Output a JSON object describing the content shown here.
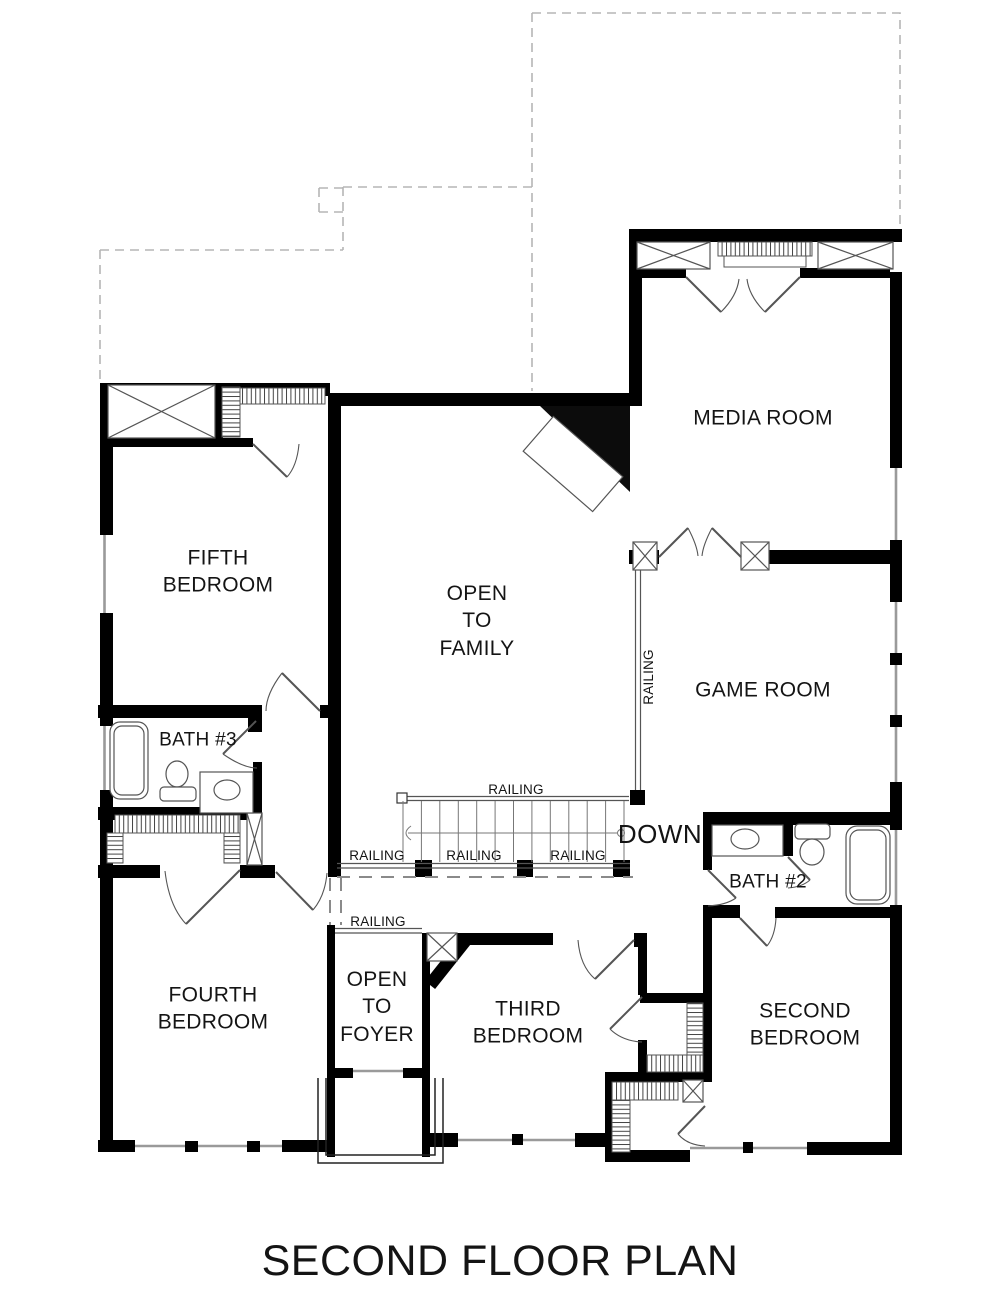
{
  "title": "SECOND FLOOR PLAN",
  "rooms": {
    "media_room": "MEDIA ROOM",
    "game_room": "GAME ROOM",
    "open_to_family": "OPEN\nTO\nFAMILY",
    "fifth_bedroom": "FIFTH\nBEDROOM",
    "bath_3": "BATH #3",
    "bath_2": "BATH #2",
    "fourth_bedroom": "FOURTH\nBEDROOM",
    "open_to_foyer": "OPEN\nTO\nFOYER",
    "third_bedroom": "THIRD\nBEDROOM",
    "second_bedroom": "SECOND\nBEDROOM"
  },
  "annotations": {
    "down": "DOWN",
    "railing": "RAILING"
  },
  "colors": {
    "wall": "#000000",
    "thin_line": "#555555",
    "window_line": "#999999",
    "roof_dash": "#b5b5b5",
    "text": "#141414",
    "background": "#ffffff"
  }
}
